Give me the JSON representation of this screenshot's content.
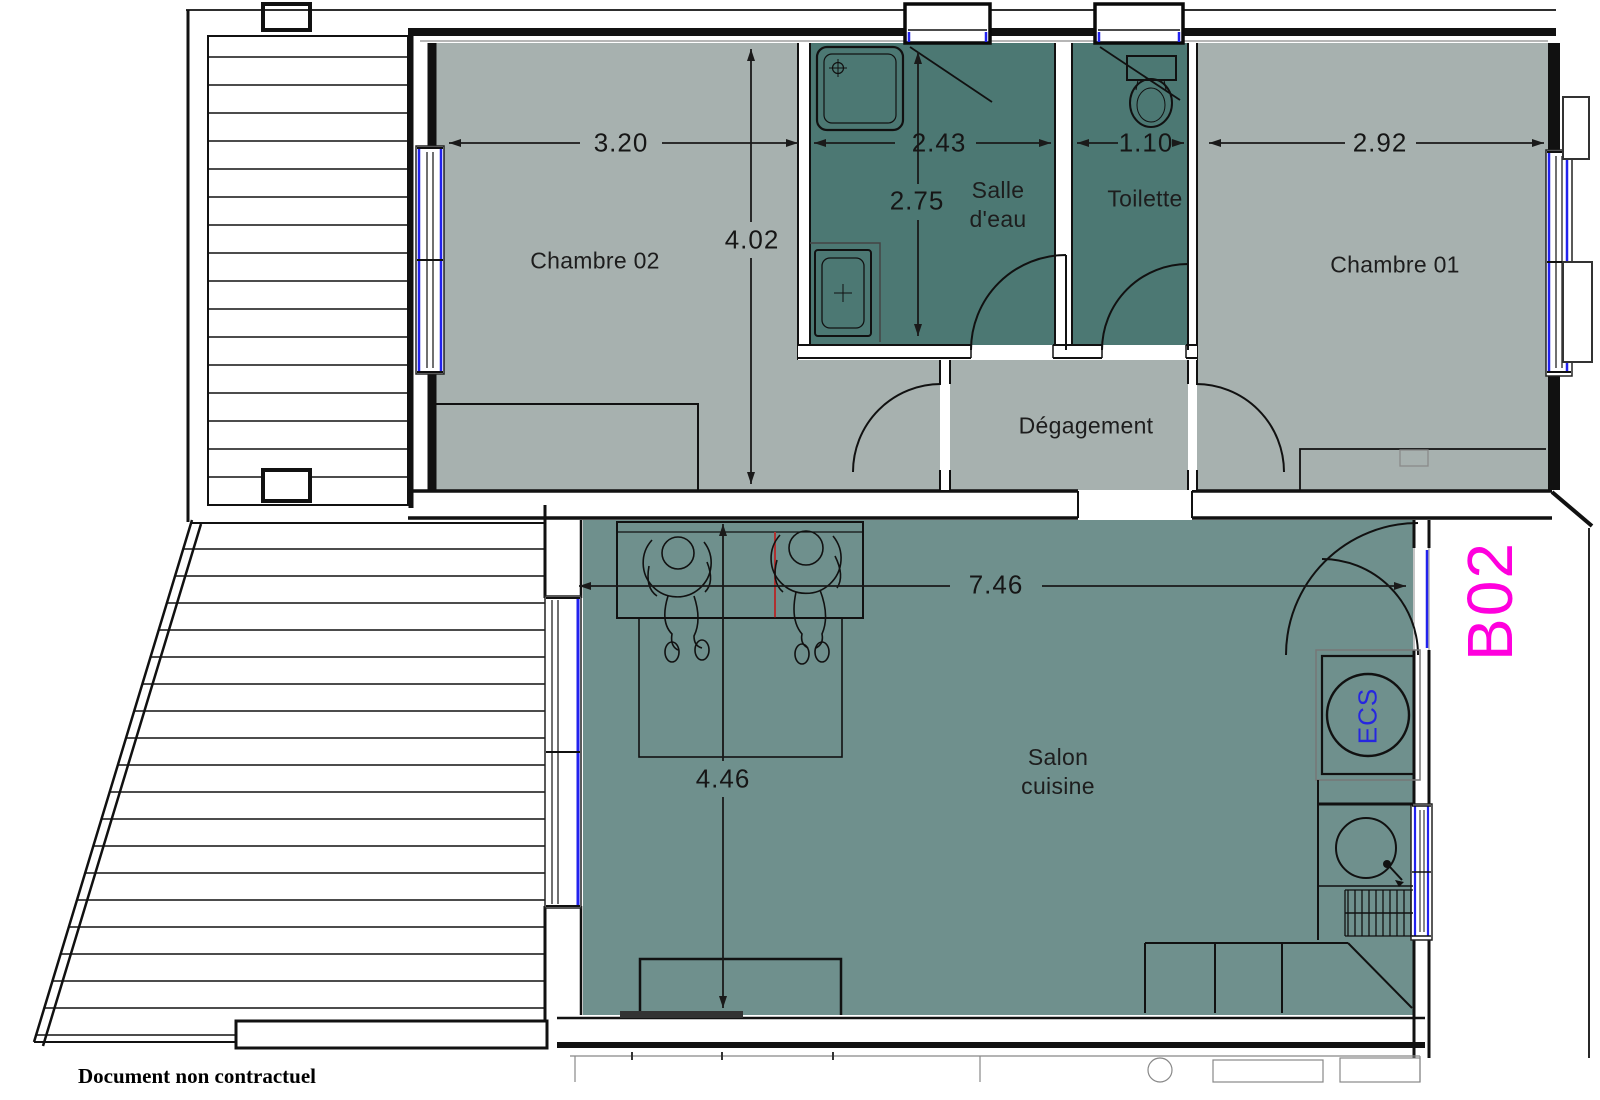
{
  "plan": {
    "unit_label": "B02",
    "footer_note": "Document non contractuel",
    "rooms": [
      {
        "id": "chambre02",
        "label": "Chambre 02"
      },
      {
        "id": "salle-deau",
        "label": "Salle d'eau",
        "line1": "Salle",
        "line2": "d'eau"
      },
      {
        "id": "toilette",
        "label": "Toilette"
      },
      {
        "id": "chambre01",
        "label": "Chambre 01"
      },
      {
        "id": "degagement",
        "label": "Dégagement"
      },
      {
        "id": "salon-cuisine",
        "label": "Salon cuisine",
        "line1": "Salon",
        "line2": "cuisine"
      }
    ],
    "dimensions_m": {
      "chambre02_width": "3.20",
      "upper_rooms_depth": "4.02",
      "salle_deau_width": "2.43",
      "salle_deau_depth": "2.75",
      "toilette_width": "1.10",
      "chambre01_width": "2.92",
      "salon_width": "7.46",
      "salon_depth": "4.46"
    },
    "equipment": {
      "water_heater": "ECS"
    },
    "colors": {
      "room_light": "#a7b1af",
      "room_dark": "#4c7873",
      "room_salon": "#6f908d",
      "window_blue": "#2222ee",
      "unit_label_magenta": "#ff00dd",
      "ecs_blue": "#2626e0",
      "line_black": "#111111",
      "marker_red": "#b03030"
    }
  }
}
